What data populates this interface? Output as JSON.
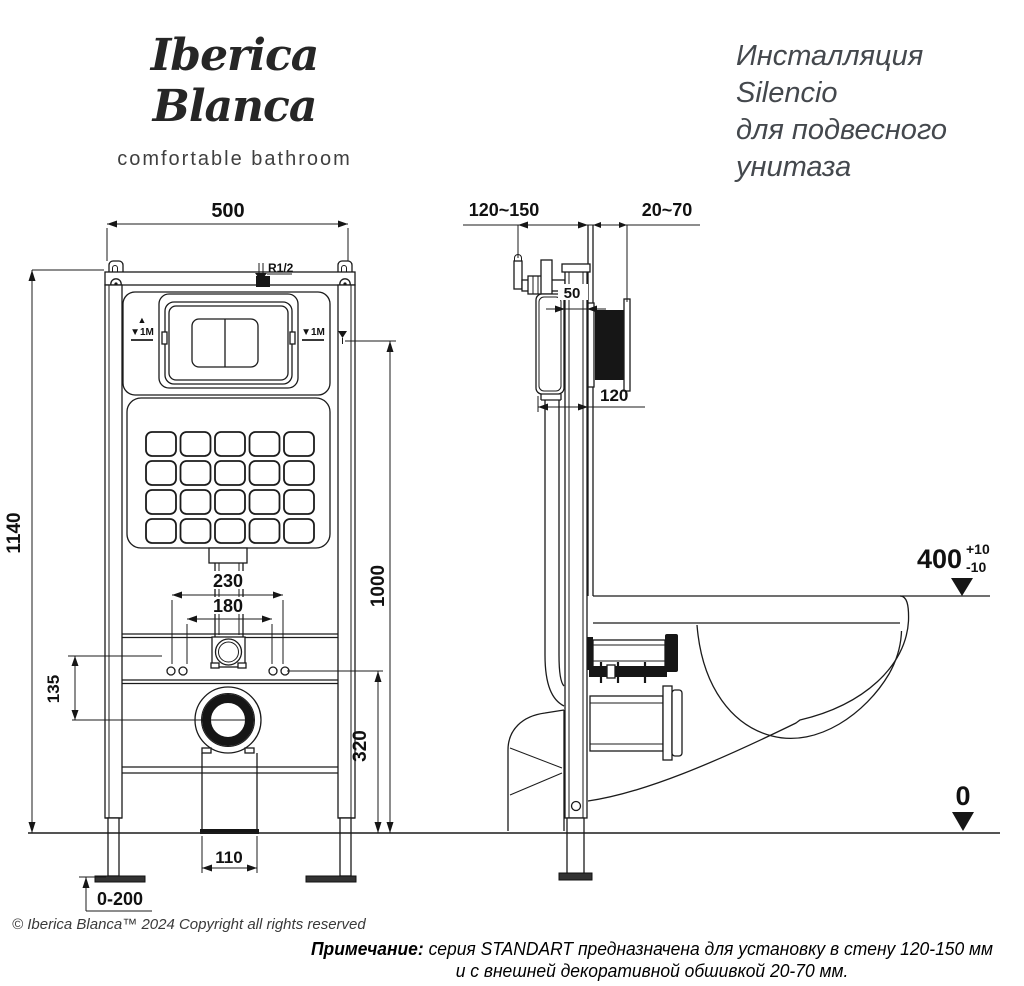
{
  "brand": {
    "name": "Iberica Blanca",
    "tagline": "comfortable bathroom"
  },
  "title": {
    "line1": "Инсталляция",
    "line2": "Silencio",
    "line3": "для подвесного",
    "line4": "унитаза"
  },
  "front_view": {
    "width": "500",
    "height": "1140",
    "mark_height": "1000",
    "pipe_centers": "230",
    "stud_centers": "180",
    "stud_to_drain": "135",
    "drain_axis_height": "320",
    "drain_box_width": "110",
    "foot_adjust": "0-200",
    "inlet_label": "R1/2",
    "level_up_glyph": "▲",
    "level_mark_left": "▼1M",
    "level_mark_right": "▼1M"
  },
  "side_view": {
    "niche_depth": "120~150",
    "cladding_depth": "20~70",
    "frame_depth": "50",
    "cistern_depth": "120",
    "rim_height": "400",
    "rim_tol_plus": "+10",
    "rim_tol_minus": "-10",
    "floor_level": "0"
  },
  "footer": {
    "copyright": "© Iberica Blanca™ 2024 Copyright all rights reserved",
    "note_label": "Примечание:",
    "note_line1": " серия STANDART предназначена для установку в стену 120-150 мм",
    "note_line2": "и с внешней декоративной обшивкой 20-70 мм."
  },
  "colors": {
    "ink": "#1b1b1b",
    "background": "#ffffff"
  }
}
